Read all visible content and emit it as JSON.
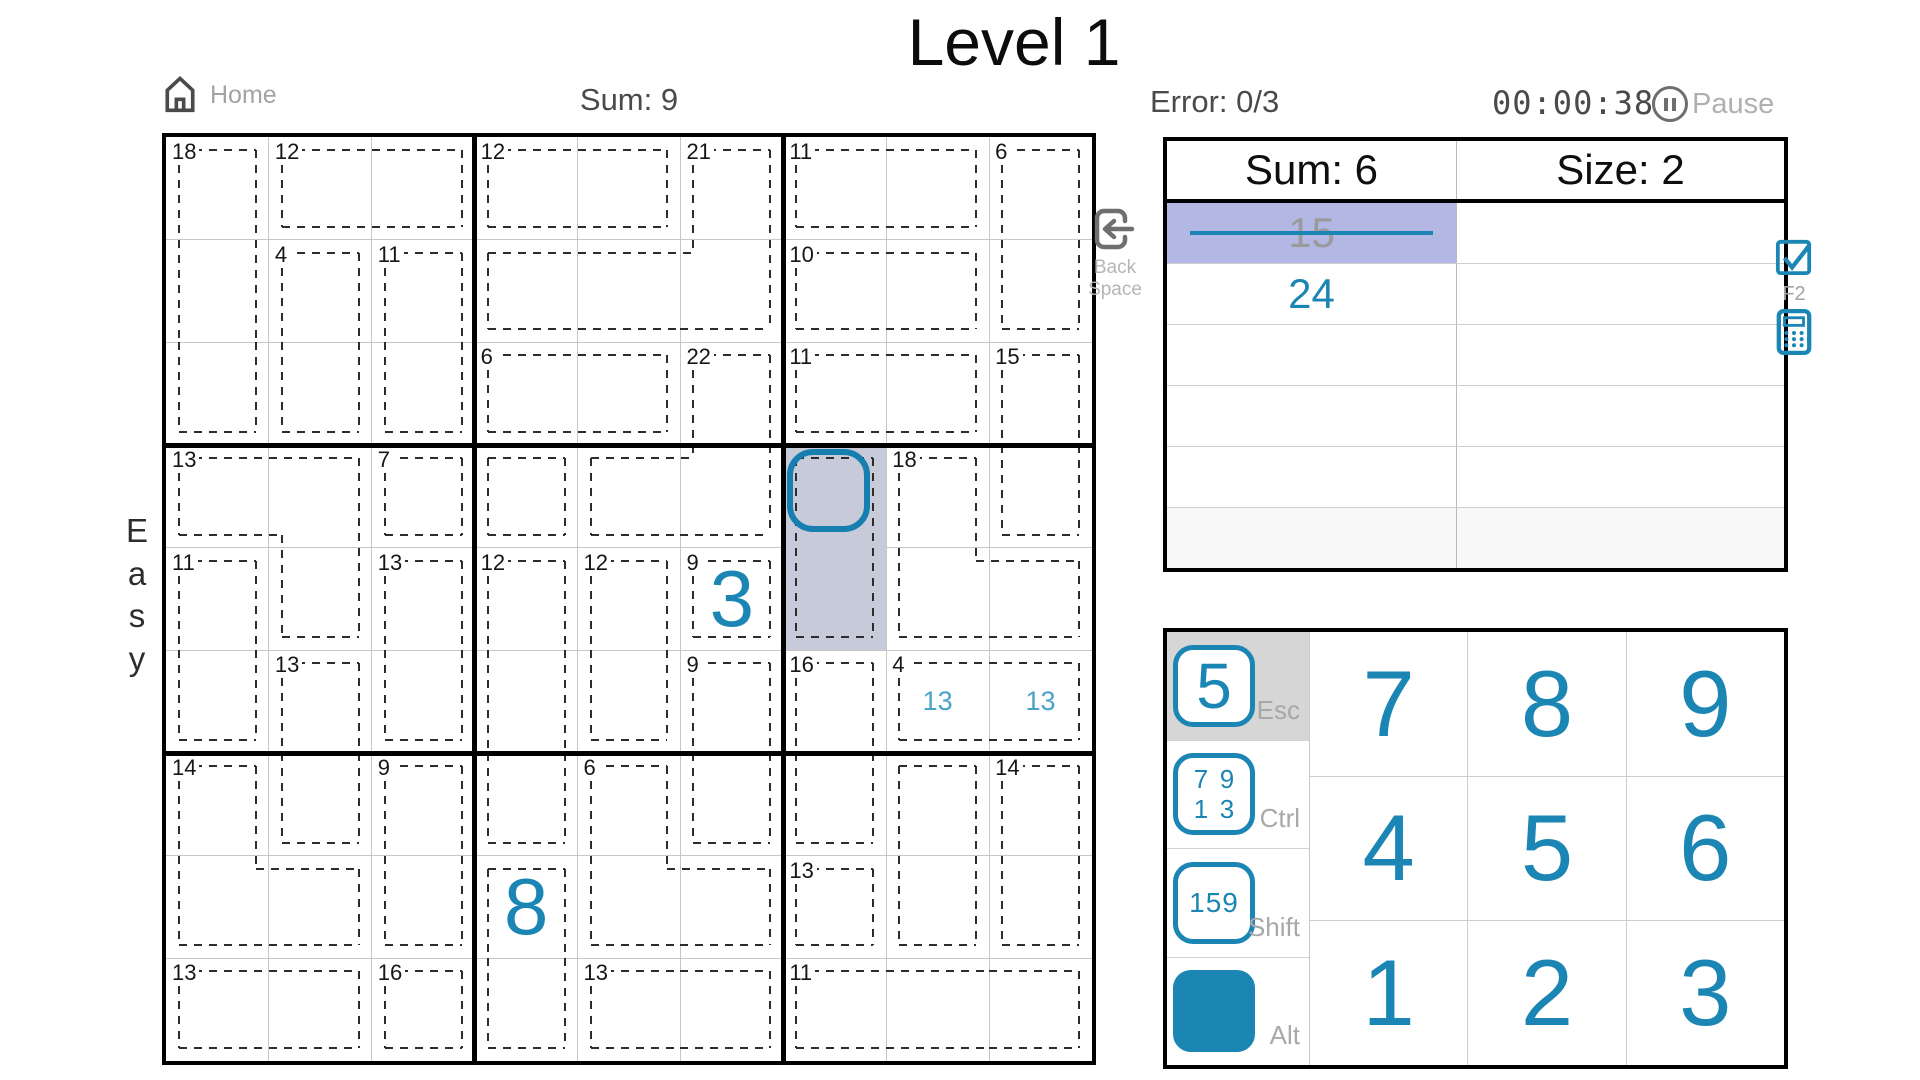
{
  "title": "Level 1",
  "difficulty": "Easy",
  "header": {
    "home_label": "Home",
    "sum_label": "Sum: 9",
    "error_label": "Error: 0/3",
    "timer": "00:00:38",
    "pause_label": "Pause"
  },
  "icons": {
    "home": "home-icon",
    "pause": "pause-icon",
    "backspace": "backspace-icon",
    "checkbox": "checkbox-checked-icon",
    "calculator": "calculator-icon"
  },
  "colors": {
    "accent": "#1b86b4",
    "note_blue": "#4aa2cb",
    "cell_select": "#c7cbd9",
    "row_highlight": "#b2b7e3",
    "cursor": "#177fb0"
  },
  "grid": {
    "size": 9,
    "cages": [
      {
        "sum": "18",
        "cells": [
          [
            0,
            0
          ],
          [
            1,
            0
          ],
          [
            2,
            0
          ]
        ]
      },
      {
        "sum": "12",
        "cells": [
          [
            0,
            1
          ],
          [
            0,
            2
          ]
        ]
      },
      {
        "sum": "4",
        "cells": [
          [
            1,
            1
          ],
          [
            2,
            1
          ]
        ]
      },
      {
        "sum": "11",
        "cells": [
          [
            1,
            2
          ],
          [
            2,
            2
          ]
        ]
      },
      {
        "sum": "12",
        "cells": [
          [
            0,
            3
          ],
          [
            0,
            4
          ]
        ]
      },
      {
        "sum": "21",
        "cells": [
          [
            0,
            5
          ],
          [
            1,
            3
          ],
          [
            1,
            4
          ],
          [
            1,
            5
          ]
        ]
      },
      {
        "sum": "6",
        "cells": [
          [
            2,
            3
          ],
          [
            2,
            4
          ]
        ]
      },
      {
        "sum": "22",
        "cells": [
          [
            2,
            5
          ],
          [
            3,
            4
          ],
          [
            3,
            5
          ]
        ]
      },
      {
        "sum": "11",
        "cells": [
          [
            0,
            6
          ],
          [
            0,
            7
          ]
        ]
      },
      {
        "sum": "6",
        "cells": [
          [
            0,
            8
          ],
          [
            1,
            8
          ]
        ]
      },
      {
        "sum": "10",
        "cells": [
          [
            1,
            6
          ],
          [
            1,
            7
          ]
        ]
      },
      {
        "sum": "11",
        "cells": [
          [
            2,
            6
          ],
          [
            2,
            7
          ]
        ]
      },
      {
        "sum": "15",
        "cells": [
          [
            2,
            8
          ],
          [
            3,
            8
          ]
        ]
      },
      {
        "sum": "13",
        "cells": [
          [
            3,
            0
          ],
          [
            3,
            1
          ],
          [
            4,
            1
          ]
        ]
      },
      {
        "sum": "7",
        "cells": [
          [
            3,
            2
          ]
        ]
      },
      {
        "sum": "",
        "cells": [
          [
            3,
            3
          ]
        ]
      },
      {
        "sum": "",
        "cells": [
          [
            3,
            6
          ],
          [
            4,
            6
          ]
        ]
      },
      {
        "sum": "18",
        "cells": [
          [
            3,
            7
          ],
          [
            4,
            7
          ],
          [
            4,
            8
          ]
        ]
      },
      {
        "sum": "11",
        "cells": [
          [
            4,
            0
          ],
          [
            5,
            0
          ]
        ]
      },
      {
        "sum": "13",
        "cells": [
          [
            4,
            2
          ],
          [
            5,
            2
          ]
        ]
      },
      {
        "sum": "12",
        "cells": [
          [
            4,
            3
          ],
          [
            5,
            3
          ],
          [
            6,
            3
          ]
        ]
      },
      {
        "sum": "12",
        "cells": [
          [
            4,
            4
          ],
          [
            5,
            4
          ]
        ]
      },
      {
        "sum": "9",
        "cells": [
          [
            4,
            5
          ]
        ]
      },
      {
        "sum": "13",
        "cells": [
          [
            5,
            1
          ],
          [
            6,
            1
          ]
        ]
      },
      {
        "sum": "9",
        "cells": [
          [
            5,
            5
          ],
          [
            6,
            5
          ]
        ]
      },
      {
        "sum": "16",
        "cells": [
          [
            5,
            6
          ],
          [
            6,
            6
          ]
        ]
      },
      {
        "sum": "4",
        "cells": [
          [
            5,
            7
          ],
          [
            5,
            8
          ]
        ]
      },
      {
        "sum": "14",
        "cells": [
          [
            6,
            0
          ],
          [
            7,
            0
          ],
          [
            7,
            1
          ]
        ]
      },
      {
        "sum": "9",
        "cells": [
          [
            6,
            2
          ],
          [
            7,
            2
          ]
        ]
      },
      {
        "sum": "6",
        "cells": [
          [
            6,
            4
          ],
          [
            7,
            4
          ],
          [
            7,
            5
          ]
        ]
      },
      {
        "sum": "",
        "cells": [
          [
            6,
            7
          ],
          [
            7,
            7
          ]
        ]
      },
      {
        "sum": "14",
        "cells": [
          [
            6,
            8
          ],
          [
            7,
            8
          ]
        ]
      },
      {
        "sum": "",
        "cells": [
          [
            7,
            3
          ],
          [
            8,
            3
          ]
        ]
      },
      {
        "sum": "13",
        "cells": [
          [
            7,
            6
          ]
        ]
      },
      {
        "sum": "13",
        "cells": [
          [
            8,
            0
          ],
          [
            8,
            1
          ]
        ]
      },
      {
        "sum": "16",
        "cells": [
          [
            8,
            2
          ]
        ]
      },
      {
        "sum": "13",
        "cells": [
          [
            8,
            4
          ],
          [
            8,
            5
          ]
        ]
      },
      {
        "sum": "11",
        "cells": [
          [
            8,
            6
          ],
          [
            8,
            7
          ],
          [
            8,
            8
          ]
        ]
      }
    ],
    "digits": [
      {
        "row": 4,
        "col": 5,
        "value": "3"
      },
      {
        "row": 7,
        "col": 3,
        "value": "8"
      }
    ],
    "notes": [
      {
        "row": 5,
        "col": 7,
        "value": "13"
      },
      {
        "row": 5,
        "col": 8,
        "value": "13"
      }
    ],
    "selection": {
      "cells": [
        [
          3,
          6
        ],
        [
          4,
          6
        ]
      ],
      "cursor_cell": [
        3,
        6
      ]
    }
  },
  "backspace": {
    "line1": "Back",
    "line2": "Space"
  },
  "side": {
    "f2_label": "F2"
  },
  "info_table": {
    "headers": [
      "Sum: 6",
      "Size: 2"
    ],
    "rows": [
      {
        "sum": "15",
        "struck": true,
        "highlight": true,
        "shaded": false
      },
      {
        "sum": "24",
        "struck": false,
        "highlight": false,
        "shaded": false
      },
      {
        "sum": "",
        "struck": false,
        "highlight": false,
        "shaded": false
      },
      {
        "sum": "",
        "struck": false,
        "highlight": false,
        "shaded": false
      },
      {
        "sum": "",
        "struck": false,
        "highlight": false,
        "shaded": false
      },
      {
        "sum": "",
        "struck": false,
        "highlight": false,
        "shaded": true
      }
    ]
  },
  "numpad": {
    "modes": [
      {
        "name": "digit",
        "label": "Esc",
        "icon_text": "5",
        "active": true
      },
      {
        "name": "corner",
        "label": "Ctrl",
        "icon_digits": [
          "7",
          "9",
          "1",
          "3"
        ],
        "active": false
      },
      {
        "name": "center",
        "label": "Shift",
        "icon_text": "159",
        "active": false
      },
      {
        "name": "color",
        "label": "Alt",
        "active": false
      }
    ],
    "alt_colors": [
      "#cc1050",
      "#2a08cc",
      "#16cc1c",
      "#c6c11d"
    ],
    "digits": [
      [
        "7",
        "8",
        "9"
      ],
      [
        "4",
        "5",
        "6"
      ],
      [
        "1",
        "2",
        "3"
      ]
    ]
  }
}
